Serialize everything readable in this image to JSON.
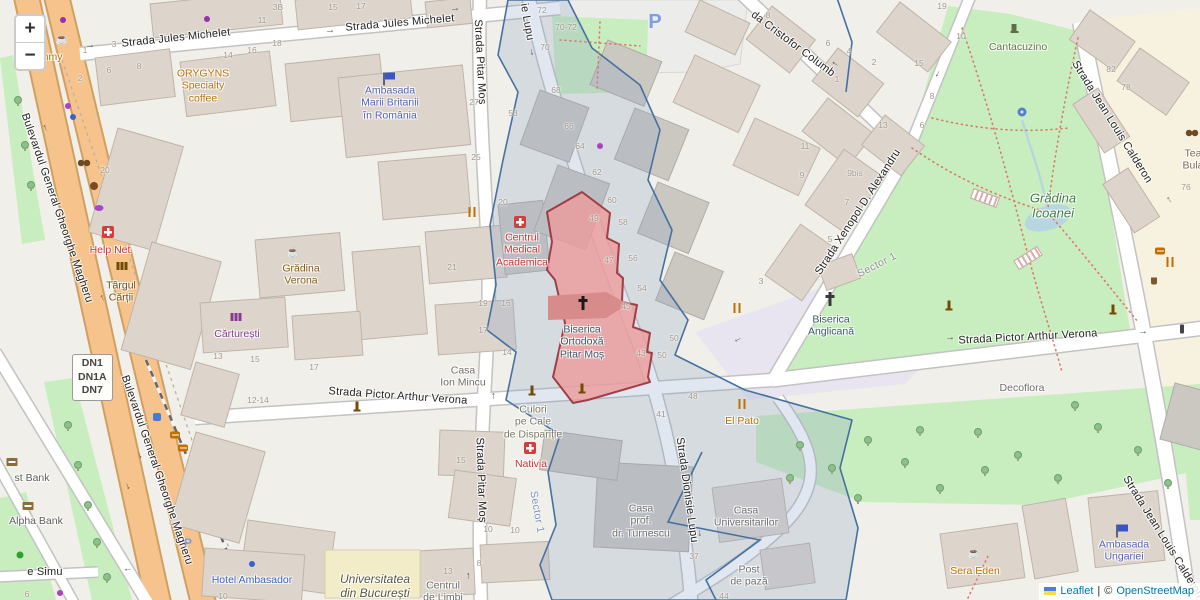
{
  "controls": {
    "zoom_in": "+",
    "zoom_out": "−"
  },
  "attribution": {
    "leaflet": "Leaflet",
    "sep": "|",
    "copyright": "©",
    "osm": "OpenStreetMap"
  },
  "route_badge": {
    "lines": [
      "DN1",
      "DN1A",
      "DN7"
    ]
  },
  "glyphs": {
    "arrow": "→",
    "cafe": "☕",
    "parking": "P"
  },
  "colors": {
    "bg": "#f1efe9",
    "highlight_fill": "#ec9b9b",
    "highlight_stroke": "#993039",
    "selected_inner": "#d88b8b",
    "boundary_line": "#46719f",
    "boundary_fill": "rgba(136,160,200,0.25)",
    "road_primary": "#f6c38d",
    "road_casing": "#d0a060",
    "park_green": "#c8edbe",
    "building": "#ddd5cc",
    "building_gray": "#cbc7c1",
    "building_yellow": "#f3ecc8",
    "water": "#b8d6e0",
    "plaza": "#e8e5f0",
    "cream": "#f7f2df"
  },
  "streets": [
    {
      "t": "Strada Jules Michelet",
      "x": 176,
      "y": 38,
      "r": -6
    },
    {
      "t": "Strada Jules Michelet",
      "x": 400,
      "y": 23,
      "r": -5
    },
    {
      "t": "Strada Pitar Moș",
      "x": 480,
      "y": 62,
      "r": 87
    },
    {
      "t": "Strada Pitar Moș",
      "x": 481,
      "y": 480,
      "r": 88
    },
    {
      "t": "ie Lupu",
      "x": 527,
      "y": 22,
      "r": 80
    },
    {
      "t": "Strada Dionisie Lupu",
      "x": 687,
      "y": 490,
      "r": 82
    },
    {
      "t": "da Cristofor Columb",
      "x": 793,
      "y": 44,
      "r": 37
    },
    {
      "t": "Strada Xenopol D. Alexandru",
      "x": 858,
      "y": 212,
      "r": -57
    },
    {
      "t": "Strada Pictor Arthur Verona",
      "x": 398,
      "y": 396,
      "r": 4
    },
    {
      "t": "Strada Pictor Arthur Verona",
      "x": 1028,
      "y": 337,
      "r": -3
    },
    {
      "t": "Strada Jean Louis Calderon",
      "x": 1112,
      "y": 122,
      "r": 58
    },
    {
      "t": "Strada Jean Louis Calderon",
      "x": 1163,
      "y": 537,
      "r": 58
    },
    {
      "t": "Bulevardul General Gheorghe Magheru",
      "x": 57,
      "y": 208,
      "r": 71
    },
    {
      "t": "Bulevardul General Gheorghe Magheru",
      "x": 157,
      "y": 470,
      "r": 71
    },
    {
      "t": "e Simu",
      "x": 45,
      "y": 572,
      "r": 0
    }
  ],
  "pois": [
    {
      "lines": [
        "Yummy"
      ],
      "x": 45,
      "y": 57,
      "c": "#c07000"
    },
    {
      "lines": [
        "ORYGYNS",
        "Specialty",
        "coffee"
      ],
      "x": 203,
      "y": 86,
      "c": "#c07000"
    },
    {
      "lines": [
        "Ambasada",
        "Marii Britanii",
        "în România"
      ],
      "x": 390,
      "y": 103,
      "c": "#5562bd"
    },
    {
      "lines": [
        "Help Net"
      ],
      "x": 110,
      "y": 250,
      "c": "#d03030"
    },
    {
      "lines": [
        "Târgul",
        "Cărții"
      ],
      "x": 121,
      "y": 292,
      "c": "#734a08"
    },
    {
      "lines": [
        "Grădina",
        "Verona"
      ],
      "x": 301,
      "y": 275,
      "c": "#8a5a12"
    },
    {
      "lines": [
        "Cărturești"
      ],
      "x": 237,
      "y": 334,
      "c": "#8a3a96"
    },
    {
      "lines": [
        "Centrul",
        "Medical",
        "Academica"
      ],
      "x": 522,
      "y": 250,
      "c": "#d03030"
    },
    {
      "lines": [
        "Casa",
        "Ion Mincu"
      ],
      "x": 463,
      "y": 377,
      "c": "#6f6f6f"
    },
    {
      "lines": [
        "Culori",
        "pe Cale",
        "de Dispariție"
      ],
      "x": 533,
      "y": 422,
      "c": "#7d7a66"
    },
    {
      "lines": [
        "Nativia"
      ],
      "x": 531,
      "y": 464,
      "c": "#d03030"
    },
    {
      "lines": [
        "Hotel Ambasador"
      ],
      "x": 252,
      "y": 580,
      "c": "#3b63c9"
    },
    {
      "lines": [
        "Universitatea",
        "din București"
      ],
      "x": 375,
      "y": 586,
      "c": "#565840",
      "i": true,
      "fs": 12
    },
    {
      "lines": [
        "Centrul",
        "de Limbi"
      ],
      "x": 443,
      "y": 592,
      "c": "#6f6f6f"
    },
    {
      "lines": [
        "Casa",
        "prof.",
        "dr. Turnescu"
      ],
      "x": 641,
      "y": 521,
      "c": "#6f6f6f"
    },
    {
      "lines": [
        "Casa",
        "Universitarilor"
      ],
      "x": 746,
      "y": 517,
      "c": "#6f6f6f"
    },
    {
      "lines": [
        "Post",
        "de pază"
      ],
      "x": 749,
      "y": 576,
      "c": "#6f6f6f"
    },
    {
      "lines": [
        "El Pato"
      ],
      "x": 742,
      "y": 421,
      "c": "#c07000"
    },
    {
      "lines": [
        "Biserica",
        "Anglicană"
      ],
      "x": 831,
      "y": 326,
      "c": "#3c5a66"
    },
    {
      "lines": [
        "Biserica",
        "Ortodoxă",
        "Pitar Moș"
      ],
      "x": 582,
      "y": 342,
      "c": "#3c5a66"
    },
    {
      "lines": [
        "Decoflora"
      ],
      "x": 1022,
      "y": 388,
      "c": "#6f6f6f"
    },
    {
      "lines": [
        "Sera Eden"
      ],
      "x": 975,
      "y": 571,
      "c": "#c07000"
    },
    {
      "lines": [
        "Ambasada",
        "Ungariei"
      ],
      "x": 1124,
      "y": 551,
      "c": "#5562bd"
    },
    {
      "lines": [
        "Grădina",
        "Icoanei"
      ],
      "x": 1053,
      "y": 206,
      "c": "#3f7d3f",
      "i": true,
      "fs": 13
    },
    {
      "lines": [
        "Cantacuzino"
      ],
      "x": 1018,
      "y": 47,
      "c": "#5c7a3c"
    },
    {
      "lines": [
        "Tea",
        "Bula"
      ],
      "x": 1193,
      "y": 160,
      "c": "#7a6a55"
    },
    {
      "lines": [
        "st Bank"
      ],
      "x": 32,
      "y": 478,
      "c": "#5e5e5e"
    },
    {
      "lines": [
        "Alpha Bank"
      ],
      "x": 36,
      "y": 521,
      "c": "#5e5e5e"
    }
  ],
  "admin_labels": [
    {
      "t": "Sector 1",
      "x": 877,
      "y": 265,
      "r": -27,
      "c": "#909090"
    },
    {
      "t": "Sector 1",
      "x": 537,
      "y": 512,
      "r": 80,
      "c": "#7a8fc0"
    }
  ],
  "house_numbers": [
    [
      "1",
      85,
      50
    ],
    [
      "3",
      114,
      44
    ],
    [
      "2",
      80,
      78
    ],
    [
      "6",
      109,
      70
    ],
    [
      "8",
      139,
      66
    ],
    [
      "14",
      228,
      55
    ],
    [
      "16",
      252,
      50
    ],
    [
      "18",
      277,
      43
    ],
    [
      "11",
      262,
      20
    ],
    [
      "3B",
      278,
      7
    ],
    [
      "15",
      333,
      7
    ],
    [
      "17",
      361,
      6
    ],
    [
      "27",
      474,
      102
    ],
    [
      "53",
      513,
      113
    ],
    [
      "72",
      542,
      10
    ],
    [
      "70-72",
      566,
      27
    ],
    [
      "70",
      545,
      47
    ],
    [
      "68",
      556,
      90
    ],
    [
      "66",
      569,
      126
    ],
    [
      "64",
      580,
      146
    ],
    [
      "62",
      597,
      172
    ],
    [
      "60",
      612,
      200
    ],
    [
      "58",
      623,
      222
    ],
    [
      "56",
      633,
      258
    ],
    [
      "54",
      642,
      288
    ],
    [
      "49",
      594,
      218
    ],
    [
      "47",
      609,
      260
    ],
    [
      "45",
      626,
      306
    ],
    [
      "43",
      641,
      353
    ],
    [
      "50",
      674,
      338
    ],
    [
      "50",
      662,
      355
    ],
    [
      "48",
      693,
      396
    ],
    [
      "41",
      661,
      414
    ],
    [
      "8",
      768,
      15
    ],
    [
      "6",
      828,
      43
    ],
    [
      "4",
      849,
      51
    ],
    [
      "2",
      874,
      62
    ],
    [
      "1",
      837,
      79
    ],
    [
      "13",
      883,
      125
    ],
    [
      "11",
      805,
      146
    ],
    [
      "19",
      942,
      6
    ],
    [
      "10",
      961,
      36
    ],
    [
      "15",
      919,
      63
    ],
    [
      "8",
      932,
      96
    ],
    [
      "6",
      922,
      125
    ],
    [
      "82",
      1111,
      69
    ],
    [
      "78",
      1126,
      87
    ],
    [
      "76",
      1186,
      187
    ],
    [
      "9",
      802,
      175
    ],
    [
      "9bis",
      855,
      173
    ],
    [
      "7",
      847,
      202
    ],
    [
      "5",
      830,
      239
    ],
    [
      "3",
      761,
      281
    ],
    [
      "20",
      105,
      170
    ],
    [
      "25",
      476,
      157
    ],
    [
      "20",
      503,
      202
    ],
    [
      "21",
      452,
      267
    ],
    [
      "19",
      483,
      303
    ],
    [
      "16",
      506,
      303
    ],
    [
      "17",
      483,
      330
    ],
    [
      "14",
      507,
      352
    ],
    [
      "17",
      314,
      367
    ],
    [
      "13",
      218,
      356
    ],
    [
      "15",
      255,
      359
    ],
    [
      "12-14",
      258,
      400
    ],
    [
      "15",
      461,
      460
    ],
    [
      "10",
      488,
      529
    ],
    [
      "10",
      515,
      530
    ],
    [
      "8",
      479,
      563
    ],
    [
      "13",
      448,
      571
    ],
    [
      "37",
      694,
      556
    ],
    [
      "44",
      724,
      596
    ],
    [
      "10",
      223,
      596
    ],
    [
      "6",
      27,
      594
    ]
  ],
  "arrows": [
    {
      "x": 90,
      "y": 46,
      "r": -7
    },
    {
      "x": 330,
      "y": 31,
      "r": -6
    },
    {
      "x": 455,
      "y": 9,
      "r": -6
    },
    {
      "x": 45,
      "y": 128,
      "r": -112
    },
    {
      "x": 102,
      "y": 298,
      "r": -112
    },
    {
      "x": 140,
      "y": 455,
      "r": 68
    },
    {
      "x": 128,
      "y": 486,
      "r": 68
    },
    {
      "x": 493,
      "y": 396,
      "r": -90
    },
    {
      "x": 468,
      "y": 576,
      "r": -90
    },
    {
      "x": 532,
      "y": 52,
      "r": 78
    },
    {
      "x": 700,
      "y": 533,
      "r": 85
    },
    {
      "x": 835,
      "y": 64,
      "r": 212
    },
    {
      "x": 938,
      "y": 74,
      "r": 118
    },
    {
      "x": 738,
      "y": 340,
      "r": 152
    },
    {
      "x": 950,
      "y": 338,
      "r": -4
    },
    {
      "x": 1143,
      "y": 332,
      "r": -4
    },
    {
      "x": 128,
      "y": 570,
      "r": 180
    },
    {
      "x": 1169,
      "y": 200,
      "r": -122
    }
  ],
  "icons": [
    {
      "k": "cafe",
      "x": 62,
      "y": 40,
      "c": "#c07000"
    },
    {
      "k": "cafe",
      "x": 293,
      "y": 253,
      "c": "#8a5a12"
    },
    {
      "k": "cafe",
      "x": 974,
      "y": 554,
      "c": "#c07000"
    },
    {
      "k": "utensils",
      "x": 472,
      "y": 212
    },
    {
      "k": "utensils",
      "x": 737,
      "y": 308
    },
    {
      "k": "utensils",
      "x": 742,
      "y": 404
    },
    {
      "k": "utensils",
      "x": 1170,
      "y": 262
    },
    {
      "k": "fastfood",
      "x": 1160,
      "y": 251
    },
    {
      "k": "fastfood",
      "x": 175,
      "y": 435
    },
    {
      "k": "fastfood",
      "x": 183,
      "y": 448
    },
    {
      "k": "basket",
      "x": 1154,
      "y": 281
    },
    {
      "k": "pharmacy",
      "x": 108,
      "y": 232
    },
    {
      "k": "pharmacy",
      "x": 520,
      "y": 222
    },
    {
      "k": "pharmacy",
      "x": 530,
      "y": 448
    },
    {
      "k": "cross",
      "x": 583,
      "y": 303,
      "c": "#1a1a1a"
    },
    {
      "k": "cross",
      "x": 830,
      "y": 299,
      "c": "#3a3a3a"
    },
    {
      "k": "flag",
      "x": 390,
      "y": 76
    },
    {
      "k": "flag",
      "x": 1123,
      "y": 528
    },
    {
      "k": "book",
      "x": 122,
      "y": 266,
      "c": "#734a08"
    },
    {
      "k": "book",
      "x": 236,
      "y": 317,
      "c": "#8a3a96"
    },
    {
      "k": "masks",
      "x": 84,
      "y": 163
    },
    {
      "k": "masks",
      "x": 1192,
      "y": 133
    },
    {
      "k": "palette",
      "x": 94,
      "y": 186
    },
    {
      "k": "bakery",
      "x": 99,
      "y": 208
    },
    {
      "k": "dot",
      "x": 63,
      "y": 20,
      "c": "#9a30b0"
    },
    {
      "k": "dot",
      "x": 207,
      "y": 19,
      "c": "#9a30b0"
    },
    {
      "k": "dot",
      "x": 68,
      "y": 106,
      "c": "#b040c0"
    },
    {
      "k": "dot",
      "x": 73,
      "y": 117,
      "c": "#3a5fd0"
    },
    {
      "k": "dot",
      "x": 600,
      "y": 146,
      "c": "#b040c0"
    },
    {
      "k": "dot",
      "x": 60,
      "y": 593,
      "c": "#b040c0"
    },
    {
      "k": "dot",
      "x": 252,
      "y": 564,
      "c": "#3a5fd0"
    },
    {
      "k": "atm",
      "x": 12,
      "y": 462
    },
    {
      "k": "atm",
      "x": 28,
      "y": 506
    },
    {
      "k": "bus",
      "x": 157,
      "y": 417
    },
    {
      "k": "monument",
      "x": 357,
      "y": 406
    },
    {
      "k": "monument",
      "x": 532,
      "y": 390
    },
    {
      "k": "monument",
      "x": 582,
      "y": 388
    },
    {
      "k": "monument",
      "x": 949,
      "y": 305
    },
    {
      "k": "monument",
      "x": 1113,
      "y": 309
    },
    {
      "k": "statue",
      "x": 1014,
      "y": 28
    },
    {
      "k": "fountain",
      "x": 1022,
      "y": 112
    },
    {
      "k": "running",
      "x": 20,
      "y": 555
    },
    {
      "k": "parking",
      "x": 655,
      "y": 22,
      "s": 20
    },
    {
      "k": "parking",
      "x": 188,
      "y": 543,
      "s": 12
    },
    {
      "k": "traffic",
      "x": 1182,
      "y": 329
    },
    {
      "k": "pergola",
      "x": 985,
      "y": 198,
      "r": 20
    },
    {
      "k": "pergola",
      "x": 1028,
      "y": 258,
      "r": -32
    }
  ],
  "trees": [
    [
      18,
      100
    ],
    [
      25,
      145
    ],
    [
      31,
      185
    ],
    [
      68,
      425
    ],
    [
      78,
      465
    ],
    [
      88,
      505
    ],
    [
      97,
      542
    ],
    [
      107,
      577
    ],
    [
      800,
      445
    ],
    [
      832,
      468
    ],
    [
      868,
      440
    ],
    [
      905,
      462
    ],
    [
      940,
      488
    ],
    [
      978,
      432
    ],
    [
      1018,
      455
    ],
    [
      1058,
      478
    ],
    [
      1098,
      427
    ],
    [
      1138,
      450
    ],
    [
      1168,
      483
    ],
    [
      858,
      498
    ],
    [
      790,
      478
    ],
    [
      920,
      430
    ],
    [
      1075,
      405
    ],
    [
      985,
      470
    ]
  ]
}
